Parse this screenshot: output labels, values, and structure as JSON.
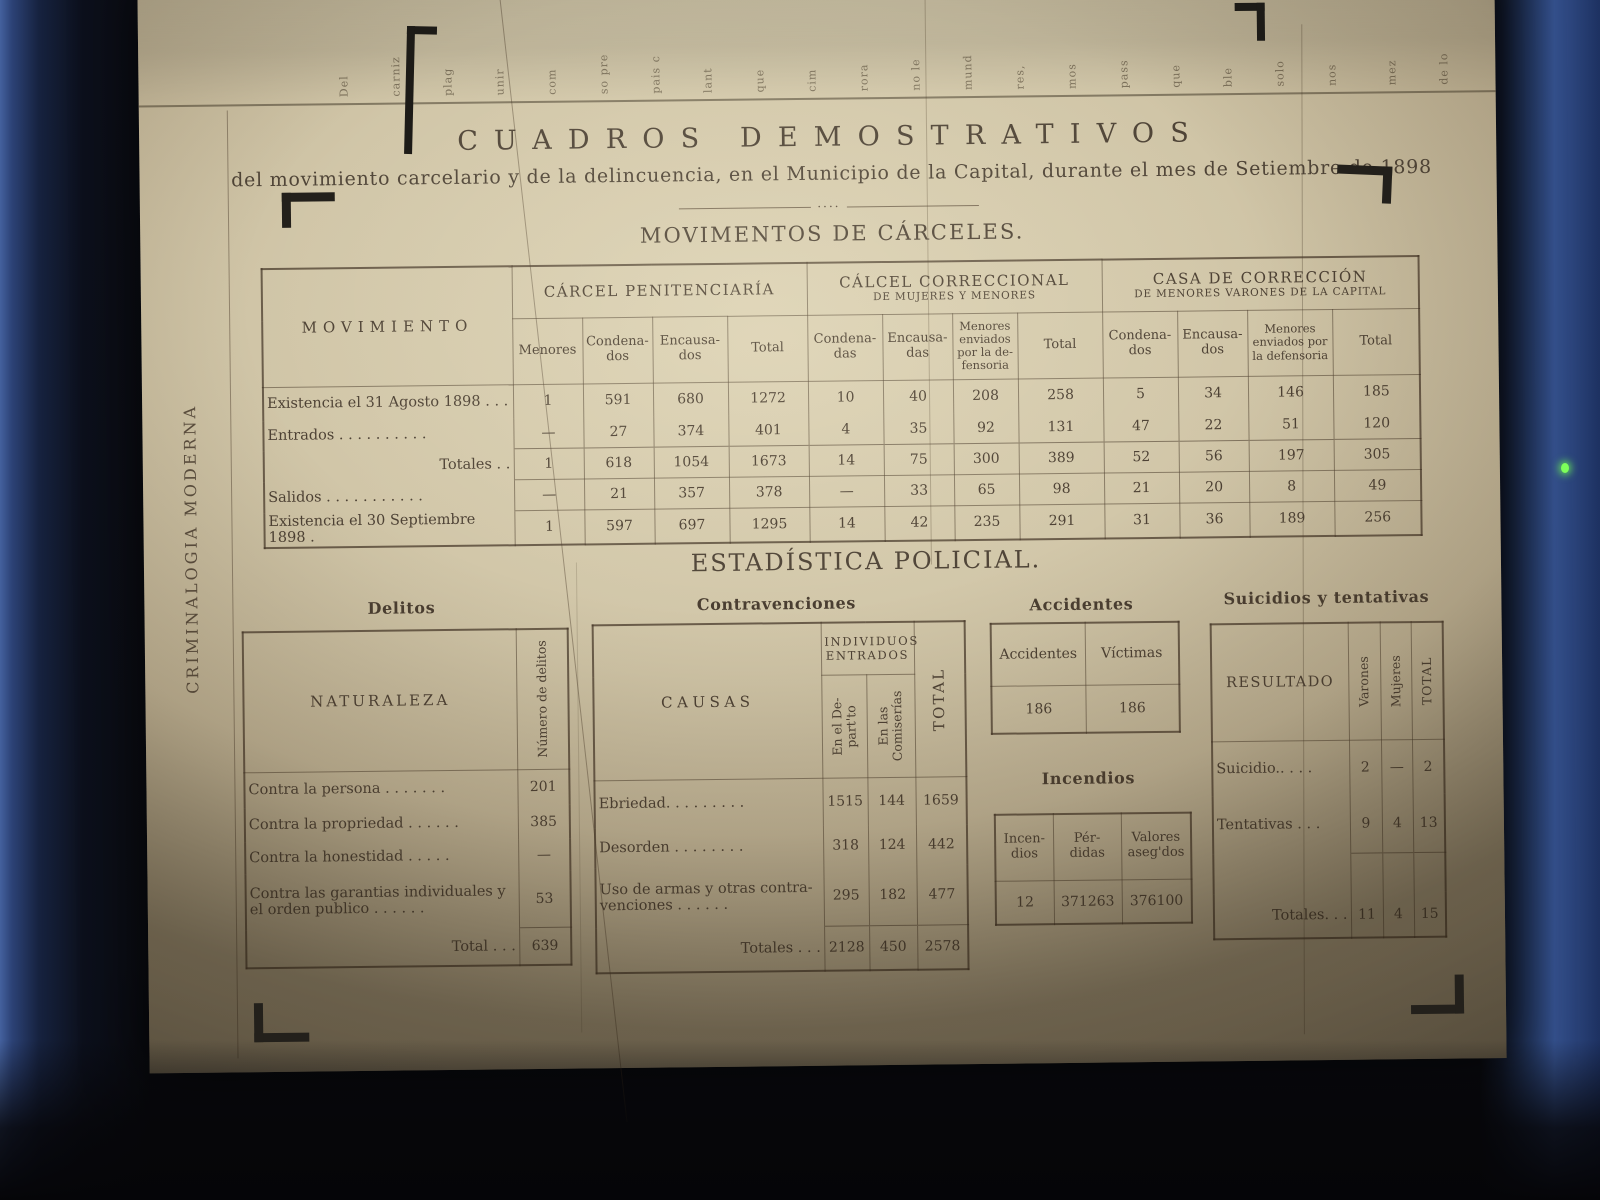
{
  "photo": {
    "margin_vertical_text": "CRIMINALOGIA MODERNA",
    "edge_fragments": [
      "Del",
      "carniz",
      "plag",
      "unir",
      "com",
      "so pre",
      "pais c",
      "lant",
      "que",
      "cim",
      "rora",
      "no le",
      "mund",
      "res,",
      "mos",
      "pass",
      "que",
      "ble",
      "solo",
      "nos",
      "mez",
      "de lo"
    ]
  },
  "header": {
    "title": "CUADROS DEMOSTRATIVOS",
    "subtitle": "del movimiento carcelario y de la delincuencia, en el Municipio de la Capital, durante el mes de Setiembre de 1898",
    "divider": "····"
  },
  "carceles": {
    "title": "MOVIMENTOS DE CÁRCELES.",
    "movimiento_header": "MOVIMIENTO",
    "groups": [
      {
        "title": "CÁRCEL PENITENCIARÍA",
        "subtitle": "",
        "cols": [
          "Menores",
          "Condena-dos",
          "Encausa-dos",
          "Total"
        ]
      },
      {
        "title": "CÁLCEL CORRECCIONAL",
        "subtitle": "DE MUJERES Y MENORES",
        "cols": [
          "Condena-das",
          "Encausa-das",
          "Menores enviados por la de-fensoria",
          "Total"
        ]
      },
      {
        "title": "CASA DE CORRECCIÓN",
        "subtitle": "DE MENORES VARONES DE LA CAPITAL",
        "cols": [
          "Condena-dos",
          "Encausa-dos",
          "Menores enviados por la defensoria",
          "Total"
        ]
      }
    ],
    "rows": [
      {
        "label": "Existencia el 31 Agosto 1898 .  .  .",
        "values": [
          "1",
          "591",
          "680",
          "1272",
          "10",
          "40",
          "208",
          "258",
          "5",
          "34",
          "146",
          "185"
        ]
      },
      {
        "label": "Entrados  .  .  .  .  .  .  .  .  .  .",
        "values": [
          "—",
          "27",
          "374",
          "401",
          "4",
          "35",
          "92",
          "131",
          "47",
          "22",
          "51",
          "120"
        ]
      },
      {
        "label": "Totales .  .",
        "values": [
          "1",
          "618",
          "1054",
          "1673",
          "14",
          "75",
          "300",
          "389",
          "52",
          "56",
          "197",
          "305"
        ]
      },
      {
        "label": "Salidos  .  .  .  .  .  .  .  .  .  .  .",
        "values": [
          "—",
          "21",
          "357",
          "378",
          "—",
          "33",
          "65",
          "98",
          "21",
          "20",
          "8",
          "49"
        ]
      },
      {
        "label": "Existencia el 30 Septiembre 1898  .",
        "values": [
          "1",
          "597",
          "697",
          "1295",
          "14",
          "42",
          "235",
          "291",
          "31",
          "36",
          "189",
          "256"
        ]
      }
    ]
  },
  "policial": {
    "title": "ESTADÍSTICA POLICIAL.",
    "delitos": {
      "label": "Delitos",
      "col1": "NATURALEZA",
      "col2": "Número de delitos",
      "rows": [
        {
          "label": "Contra la persona  .  .  .  .  .  .  .",
          "value": "201"
        },
        {
          "label": "Contra la propriedad  .  .  .  .  .  .",
          "value": "385"
        },
        {
          "label": "Contra la honestidad  .  .  .  .  .",
          "value": "—"
        },
        {
          "label": "Contra las garantias individuales y el orden publico  .  .  .  .  .  .",
          "value": "53"
        }
      ],
      "total_label": "Total .  .  .",
      "total": "639"
    },
    "contravenciones": {
      "label": "Contravenciones",
      "col1": "CAUSAS",
      "group": "INDIVIDUOS ENTRADOS",
      "cols": [
        "En el De-part'to",
        "En las Comiserías",
        "TOTAL"
      ],
      "rows": [
        {
          "label": "Ebriedad.  .  .  .  .  .  .  .  .",
          "values": [
            "1515",
            "144",
            "1659"
          ]
        },
        {
          "label": "Desorden .  .  .  .  .  .  .  .",
          "values": [
            "318",
            "124",
            "442"
          ]
        },
        {
          "label": "Uso de armas y otras contra-venciones  .  .  .  .  .  .",
          "values": [
            "295",
            "182",
            "477"
          ]
        },
        {
          "label": "Totales .  .  .",
          "values": [
            "2128",
            "450",
            "2578"
          ]
        }
      ]
    },
    "accidentes": {
      "label": "Accidentes",
      "cols": [
        "Accidentes",
        "Víctimas"
      ],
      "values": [
        "186",
        "186"
      ]
    },
    "incendios": {
      "label": "Incendios",
      "cols": [
        "Incen-dios",
        "Pér-didas",
        "Valores aseg'dos"
      ],
      "values": [
        "12",
        "371263",
        "376100"
      ]
    },
    "suicidios": {
      "label": "Suicidios y tentativas",
      "col1": "RESULTADO",
      "cols": [
        "Varones",
        "Mujeres",
        "TOTAL"
      ],
      "rows": [
        {
          "label": "Suicidio..  .  .  .",
          "values": [
            "2",
            "—",
            "2"
          ]
        },
        {
          "label": "Tentativas .  .  .",
          "values": [
            "9",
            "4",
            "13"
          ]
        },
        {
          "label": "Totales.  .  .",
          "values": [
            "11",
            "4",
            "15"
          ]
        }
      ]
    }
  }
}
